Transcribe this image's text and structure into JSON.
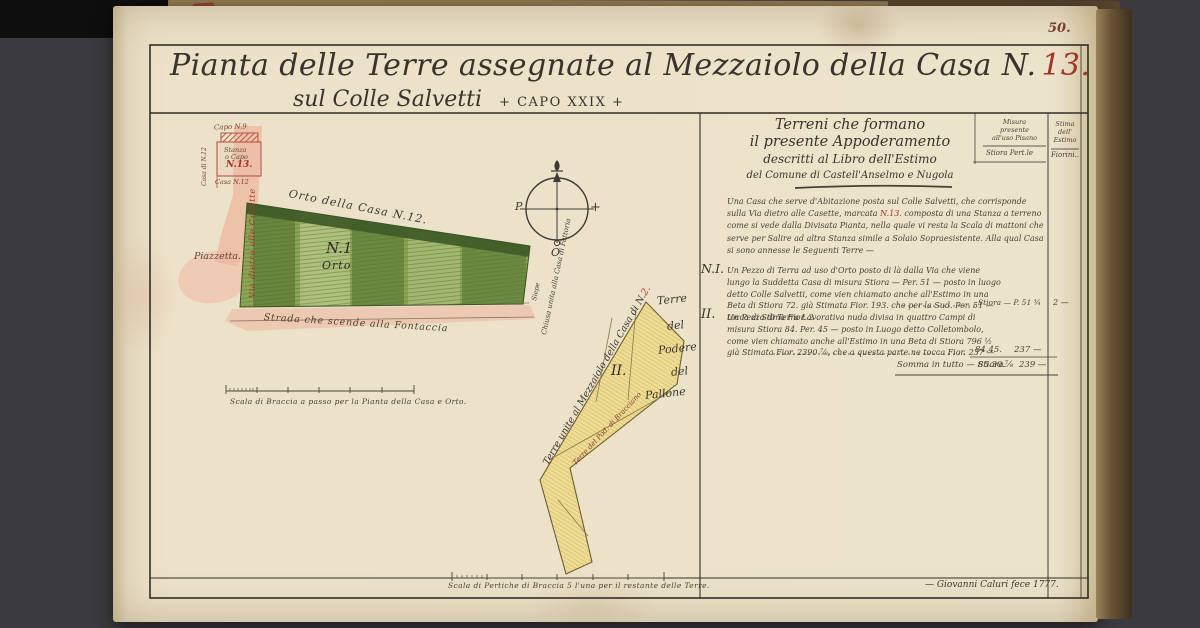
{
  "folio": "50.",
  "title": {
    "line1": "Pianta delle Terre assegnate al Mezzaiolo della Casa N.",
    "line1_red": "13.",
    "line2a": "sul Colle Salvetti",
    "line2b": "+ CAPO XXIX +"
  },
  "map": {
    "inset": {
      "capo9": "Capo N.9",
      "left_side": "Casa di N.12",
      "stanza1": "Stanza",
      "stanza2": "o Capo",
      "stanza_red": "N.13.",
      "casa12": "Casa N.12"
    },
    "road_label": "Via dietro alle Casette",
    "piazzetta": "Piazzetta.",
    "green": {
      "top_label": "Orto della Casa N.12.",
      "num": "N.1",
      "name": "Orto",
      "strada": "Strada che scende alla Fontaccia",
      "siepe": "Siepe",
      "chiusa": "Chiusa unita alla Casa di Fattoria"
    },
    "compass": {
      "west": "P",
      "south": "O",
      "east_cross": "+"
    },
    "yellow": {
      "left_label": "Terre unite al Mezzaiolo della Casa di N.",
      "left_label_red": "2.",
      "num": "II.",
      "pallone": [
        "Terre",
        "del",
        "Podere",
        "del",
        "Pallone"
      ],
      "bottom_label": "Terre del Pod. di Bracciano"
    },
    "scale_braccia": "Scala di Braccia a passo per la Pianta della Casa e Orto.",
    "scale_pertiche": "Scala di Pertiche di Braccia 5 l'una per il restante delle Terre.",
    "signature": "— Giovanni Caluri fece 1777."
  },
  "panel": {
    "header": [
      "Terreni che formano",
      "il presente Appoderamento",
      "descritti al Libro dell'Estimo",
      "del Comune di Castell'Anselmo e Nugola"
    ],
    "col_misura": [
      "Misura",
      "presente",
      "all'uso Pisano",
      "Stiora Pert.le"
    ],
    "col_stima": [
      "Stima",
      "dell'",
      "Estimo",
      "Fiorini.."
    ],
    "para1": {
      "s1": "Una Casa che serve d'Abitazione posta sul Colle Salvetti, che corrisponde sulla Via dietro alle Casette, marcata ",
      "red": "N.13.",
      "s2": " composta di una Stanza a terreno come si vede dalla Divisata Pianta, nella quale vi resta la Scala di mattoni che serve per Salire ad altra Stanza simile a Solaio Sopraesistente. Alla qual Casa si sono annesse le Seguenti Terre —"
    },
    "entry1": {
      "num": "N.I.",
      "text": "Un Pezzo di Terra ad uso d'Orto posto di là dalla Via che viene lungo la Suddetta Casa di misura Stiora — Per. 51 — posto in luogo detto Colle Salvetti, come vien chiamato anche all'Estimo in una Beta di Stiora 72. già Stimata Fior. 193. che per la Sud. Per. 51 — tocca di Stima Fior. 2 .",
      "measure": "Stiora — P. 51 ¾",
      "value": "2 —"
    },
    "entry2": {
      "num": "II.",
      "text": "Un Pezzo di Terra Lavorativa nuda divisa in quattro Campi di misura Stiora 84. Per. 45 — posto in Luogo detto Colletombolo, come vien chiamato anche all'Estimo in una Beta di Stiora 796 ½ già Stimata Fior. 2390 ⅞, che a questa parte ne tocca Fior. 237 —",
      "measure": "84.45.",
      "value": "237 —"
    },
    "somma": {
      "label": "Somma in tutto — Stiora.",
      "measure": "85.30.⅞",
      "value": "239 —"
    }
  }
}
